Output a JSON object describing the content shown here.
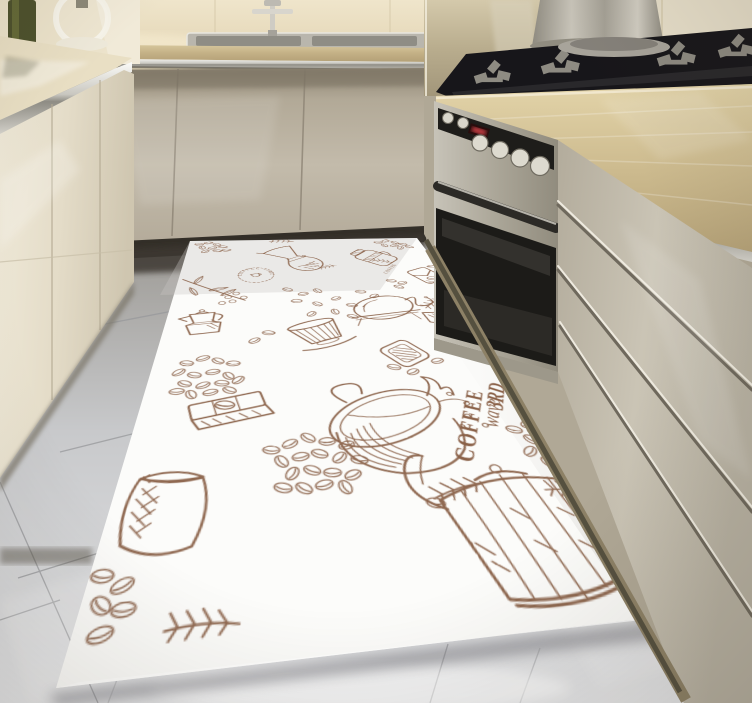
{
  "scene": {
    "title": "Modern beige kitchen with 3D coffee-print floor runner rug",
    "room_style": "glossy cream L-shaped kitchen, 3D render",
    "objects": [
      "upper-cabinets",
      "green-glass-bottle",
      "glass-kettle",
      "inset-sink",
      "chrome-faucet",
      "marble-backsplash",
      "granite-countertop",
      "gas-cooktop",
      "cylindrical-range-hood",
      "built-in-stainless-oven",
      "drawer-cabinets",
      "grey-gloss-tile-floor",
      "coffee-print-runner-rug"
    ]
  },
  "rug": {
    "style": "white runner with sepia hand-drawn coffee sketch pattern",
    "texts": {
      "stamp": "COFFEE TIME",
      "jar": "COFFEE",
      "line1": "3RD",
      "line2": "wave",
      "line3": "COFFEE"
    },
    "motifs": [
      "chemex-brewer",
      "coffee-time-stamp",
      "lidded-mug",
      "coffee-branch-with-berries",
      "moka-pot",
      "ribbed-dripper-cup",
      "balance-syphon-bulb",
      "canister-jar",
      "lying-percolator",
      "pouch-bag",
      "chocolate-bar-with-bean",
      "burlap-sack",
      "coffee-bean-piles",
      "splashing-coffee-cup",
      "3rd-wave-coffee-lettering",
      "herb-sprigs",
      "swan-neck-coffee-pot"
    ]
  },
  "palette": {
    "wall_marble": "#e7dcc2",
    "counter_granite": "#cdbb8f",
    "cabinet_greige": "#bdb4a4",
    "cabinet_cream": "#ece5d2",
    "stainless": "#b5b1a6",
    "cooktop_glass": "#1a191c",
    "oven_glass": "#211f1c",
    "oven_display_red": "#e0474e",
    "floor_tile": "#cfd0d3",
    "rug_base": "#fcfcfa",
    "rug_ink": "#8a6148",
    "shadow_dark": "#37332b"
  }
}
